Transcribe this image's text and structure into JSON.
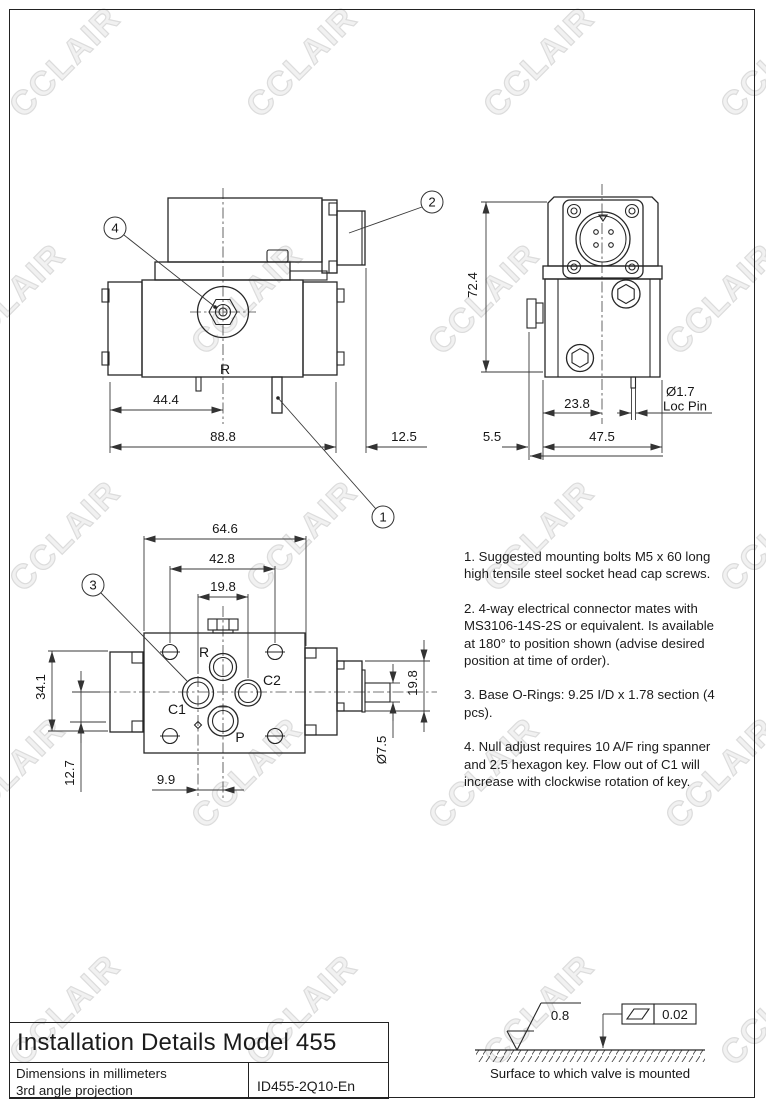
{
  "sheet": {
    "title": "Installation Details Model 455",
    "units_line": "Dimensions in millimeters",
    "projection_line": "3rd angle projection",
    "doc_number": "ID455-2Q10-En"
  },
  "watermark": {
    "text": "CCLAIR",
    "color": "#dcdcdc"
  },
  "notes": {
    "note1": "1. Suggested mounting bolts M5 x 60 long high tensile steel socket head cap screws.",
    "note2": "2. 4-way electrical connector mates with MS3106-14S-2S or equivalent. Is available at 180° to position shown (advise desired position at time of order).",
    "note3": "3. Base O-Rings: 9.25 I/D x 1.78 section (4 pcs).",
    "note4": "4. Null adjust requires 10 A/F ring spanner and 2.5 hexagon key. Flow out of C1 will increase with clockwise rotation of key."
  },
  "side_view": {
    "dim_mount_to_center": "44.4",
    "dim_overall_width": "88.8",
    "dim_connector_overhang": "12.5",
    "port_label": "R",
    "callout_null_adjust": "4",
    "callout_connector": "2",
    "callout_loc_pin": "1"
  },
  "end_view": {
    "dim_height": "72.4",
    "dim_edge_to_center": "23.8",
    "dim_tab_overhang": "5.5",
    "dim_body_width": "47.5",
    "loc_pin_dia": "Ø1.7",
    "loc_pin_label": "Loc Pin"
  },
  "bottom_view": {
    "dim_overall": "64.6",
    "dim_bolt_spacing_h": "42.8",
    "dim_port_spacing": "19.8",
    "dim_bolt_spacing_v": "34.1",
    "dim_center_to_p": "12.7",
    "dim_c1_offset": "9.9",
    "dim_connector_height": "19.8",
    "dim_spigot_dia": "Ø7.5",
    "label_r": "R",
    "label_c1": "C1",
    "label_c2": "C2",
    "label_p": "P",
    "callout_orings": "3"
  },
  "mounting_surface": {
    "roughness": "0.8",
    "flatness_tolerance": "0.02",
    "caption": "Surface to which valve is mounted"
  }
}
